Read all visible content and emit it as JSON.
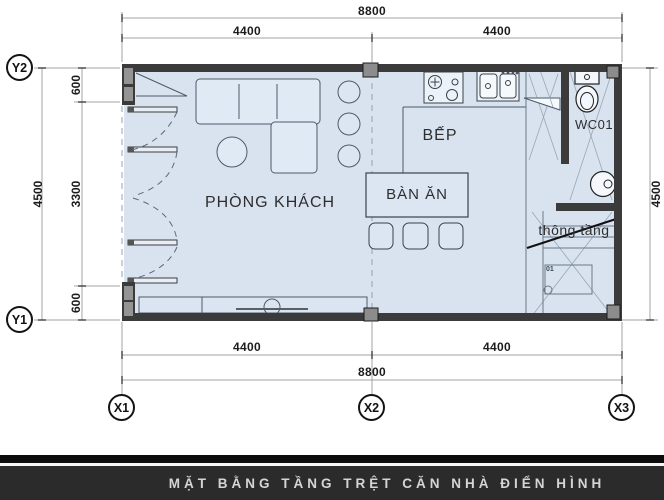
{
  "caption": "MẶT BẰNG TẦNG TRỆT CĂN NHÀ ĐIỂN HÌNH",
  "rooms": {
    "living_room": "PHÒNG KHÁCH",
    "kitchen": "BẾP",
    "dining_table": "BÀN ĂN",
    "wc": "WC01",
    "void": "thông tầng"
  },
  "grid_labels": {
    "y2": "Y2",
    "y1": "Y1",
    "x1": "X1",
    "x2": "X2",
    "x3": "X3"
  },
  "dimensions": {
    "top_total": "8800",
    "top_left_span": "4400",
    "top_right_span": "4400",
    "bottom_left_span": "4400",
    "bottom_right_span": "4400",
    "bottom_total": "8800",
    "left_total": "4500",
    "left_top_seg": "600",
    "left_mid_seg": "3300",
    "left_bottom_seg": "600",
    "right_total": "4500"
  },
  "stairs": {
    "first_step_label": "01"
  },
  "colors": {
    "floor": "#d9e3f0",
    "wall": "#3b3b3b",
    "caption_bar": "#2b2b2b",
    "caption_text": "#d5d5d5"
  }
}
